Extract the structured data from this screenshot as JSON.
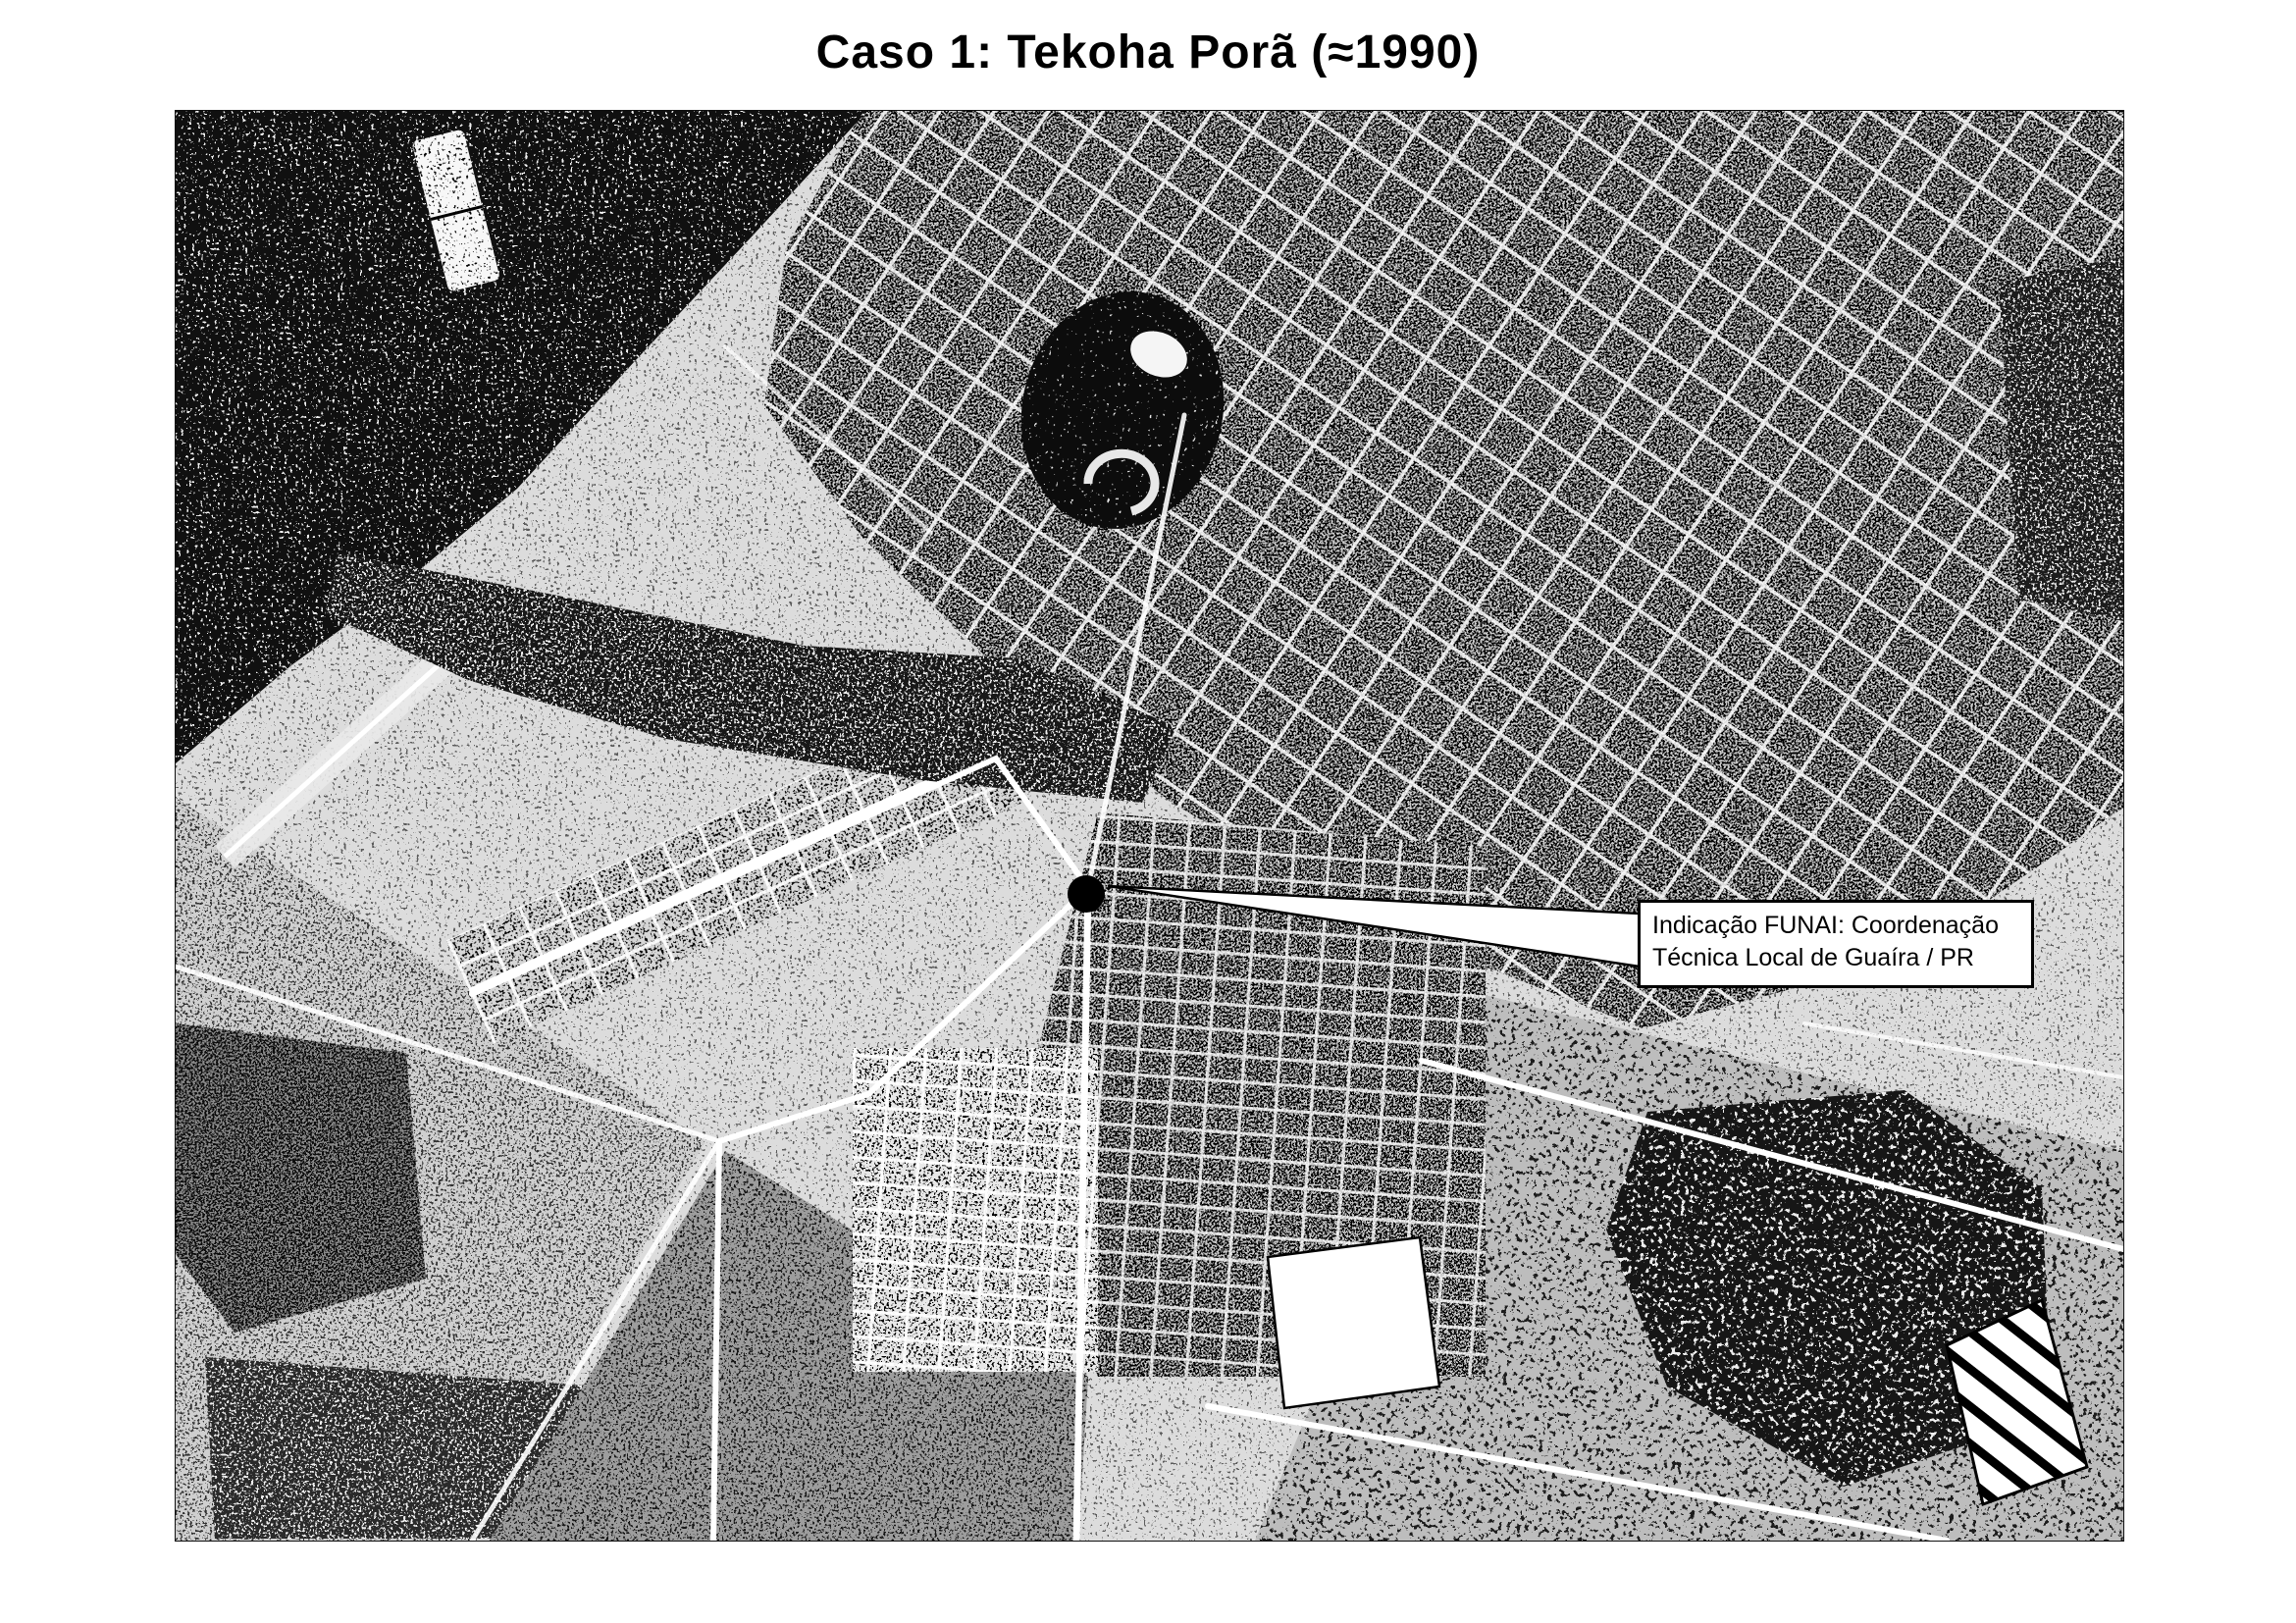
{
  "title": "Caso 1: Tekoha Porã (≈1990)",
  "photo": {
    "description": "Halftone black-and-white aerial photograph of the town of Guaíra (PR)",
    "callout": {
      "line1": "Indicação FUNAI: Coordenação",
      "line2": "Técnica Local de Guaíra / PR"
    },
    "marker": "filled black circle"
  },
  "colors": {
    "ink": "#000000",
    "paper": "#ffffff"
  }
}
